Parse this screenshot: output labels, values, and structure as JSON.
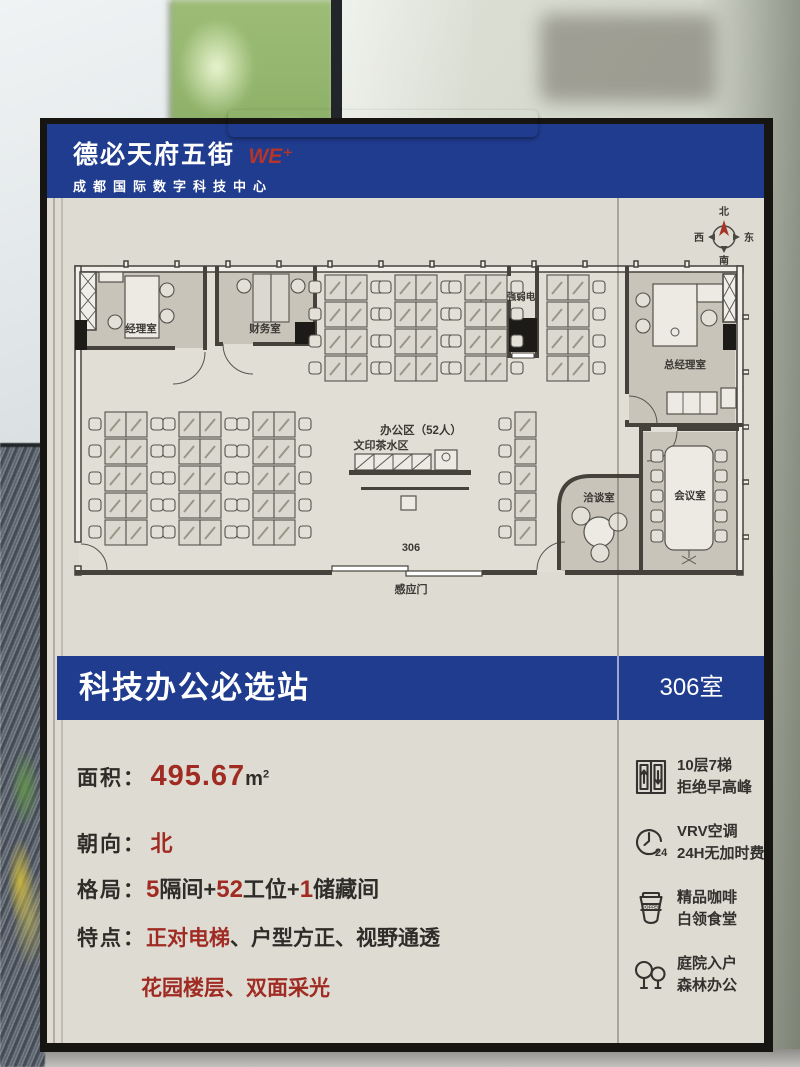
{
  "colors": {
    "brand_blue": "#203c8e",
    "accent_red": "#9f2b23",
    "poster_beige": "#dedbd2"
  },
  "header": {
    "brand": "德必天府五街",
    "brand_mark": "WE⁺",
    "subtitle": "成都国际数字科技中心"
  },
  "compass": {
    "n": "北",
    "e": "东",
    "s": "南",
    "w": "西"
  },
  "floorplan": {
    "labels": {
      "manager_office": "经理室",
      "finance_office": "财务室",
      "power_room": "强弱电",
      "gm_office": "总经理室",
      "office_area": "办公区（52人）",
      "print_tea_area": "文印茶水区",
      "negotiation_room": "洽谈室",
      "meeting_room": "会议室",
      "room_number": "306",
      "sensor_door": "感应门"
    }
  },
  "banner": {
    "title": "科技办公必选站",
    "room": "306室"
  },
  "specs": {
    "area": {
      "label": "面积：",
      "value": "495.67",
      "unit": "m",
      "sup": "2"
    },
    "orientation": {
      "label": "朝向：",
      "value": "北"
    },
    "layout": {
      "label": "格局：",
      "p1": "5",
      "p2": "隔间+",
      "p3": "52",
      "p4": "工位+",
      "p5": "1",
      "p6": "储藏间"
    },
    "features": {
      "label": "特点：",
      "f1": "正对电梯",
      "sep1": "、",
      "f2": "户型方正",
      "sep2": "、",
      "f3": "视野通透"
    },
    "features2": {
      "f1": "花园楼层",
      "sep": "、",
      "f2": "双面采光"
    }
  },
  "amenities": [
    {
      "name": "elevator",
      "line1": "10层7梯",
      "line2": "拒绝早高峰"
    },
    {
      "name": "hvac",
      "line1": "VRV空调",
      "line2": "24H无加时费",
      "badge": "24"
    },
    {
      "name": "coffee",
      "line1": "精品咖啡",
      "line2": "白领食堂",
      "badge": "COFFEE"
    },
    {
      "name": "garden",
      "line1": "庭院入户",
      "line2": "森林办公"
    }
  ]
}
